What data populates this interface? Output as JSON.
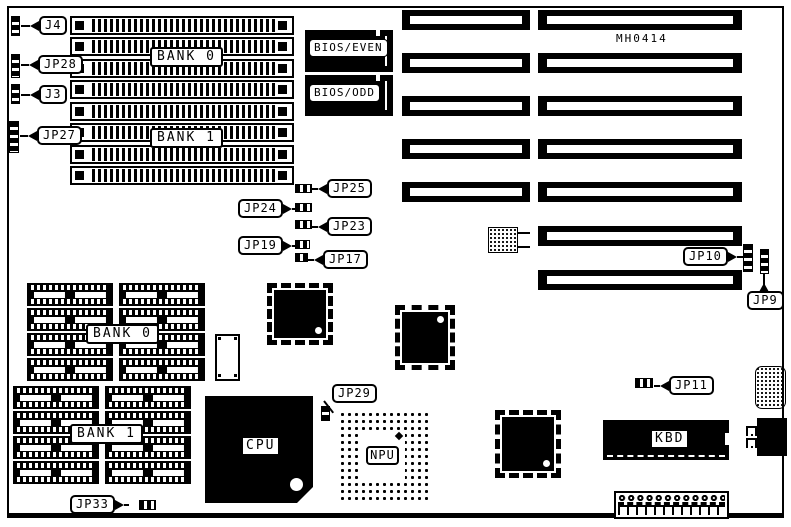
{
  "board": {
    "part_number": "MH0414",
    "simm": {
      "bank0": "BANK 0",
      "bank1": "BANK 1"
    },
    "dram": {
      "bank0": "BANK 0",
      "bank1": "BANK 1"
    },
    "chips": {
      "bios_even": "BIOS/EVEN",
      "bios_odd": "BIOS/ODD",
      "cpu": "CPU",
      "npu": "NPU",
      "kbd": "KBD"
    },
    "jumpers": {
      "j4": "J4",
      "jp28": "JP28",
      "j3": "J3",
      "jp27": "JP27",
      "jp25": "JP25",
      "jp24": "JP24",
      "jp23": "JP23",
      "jp19": "JP19",
      "jp17": "JP17",
      "jp10": "JP10",
      "jp9": "JP9",
      "jp11": "JP11",
      "jp29": "JP29",
      "jp33": "JP33"
    },
    "colors": {
      "ink": "#000000",
      "paper": "#ffffff"
    }
  }
}
